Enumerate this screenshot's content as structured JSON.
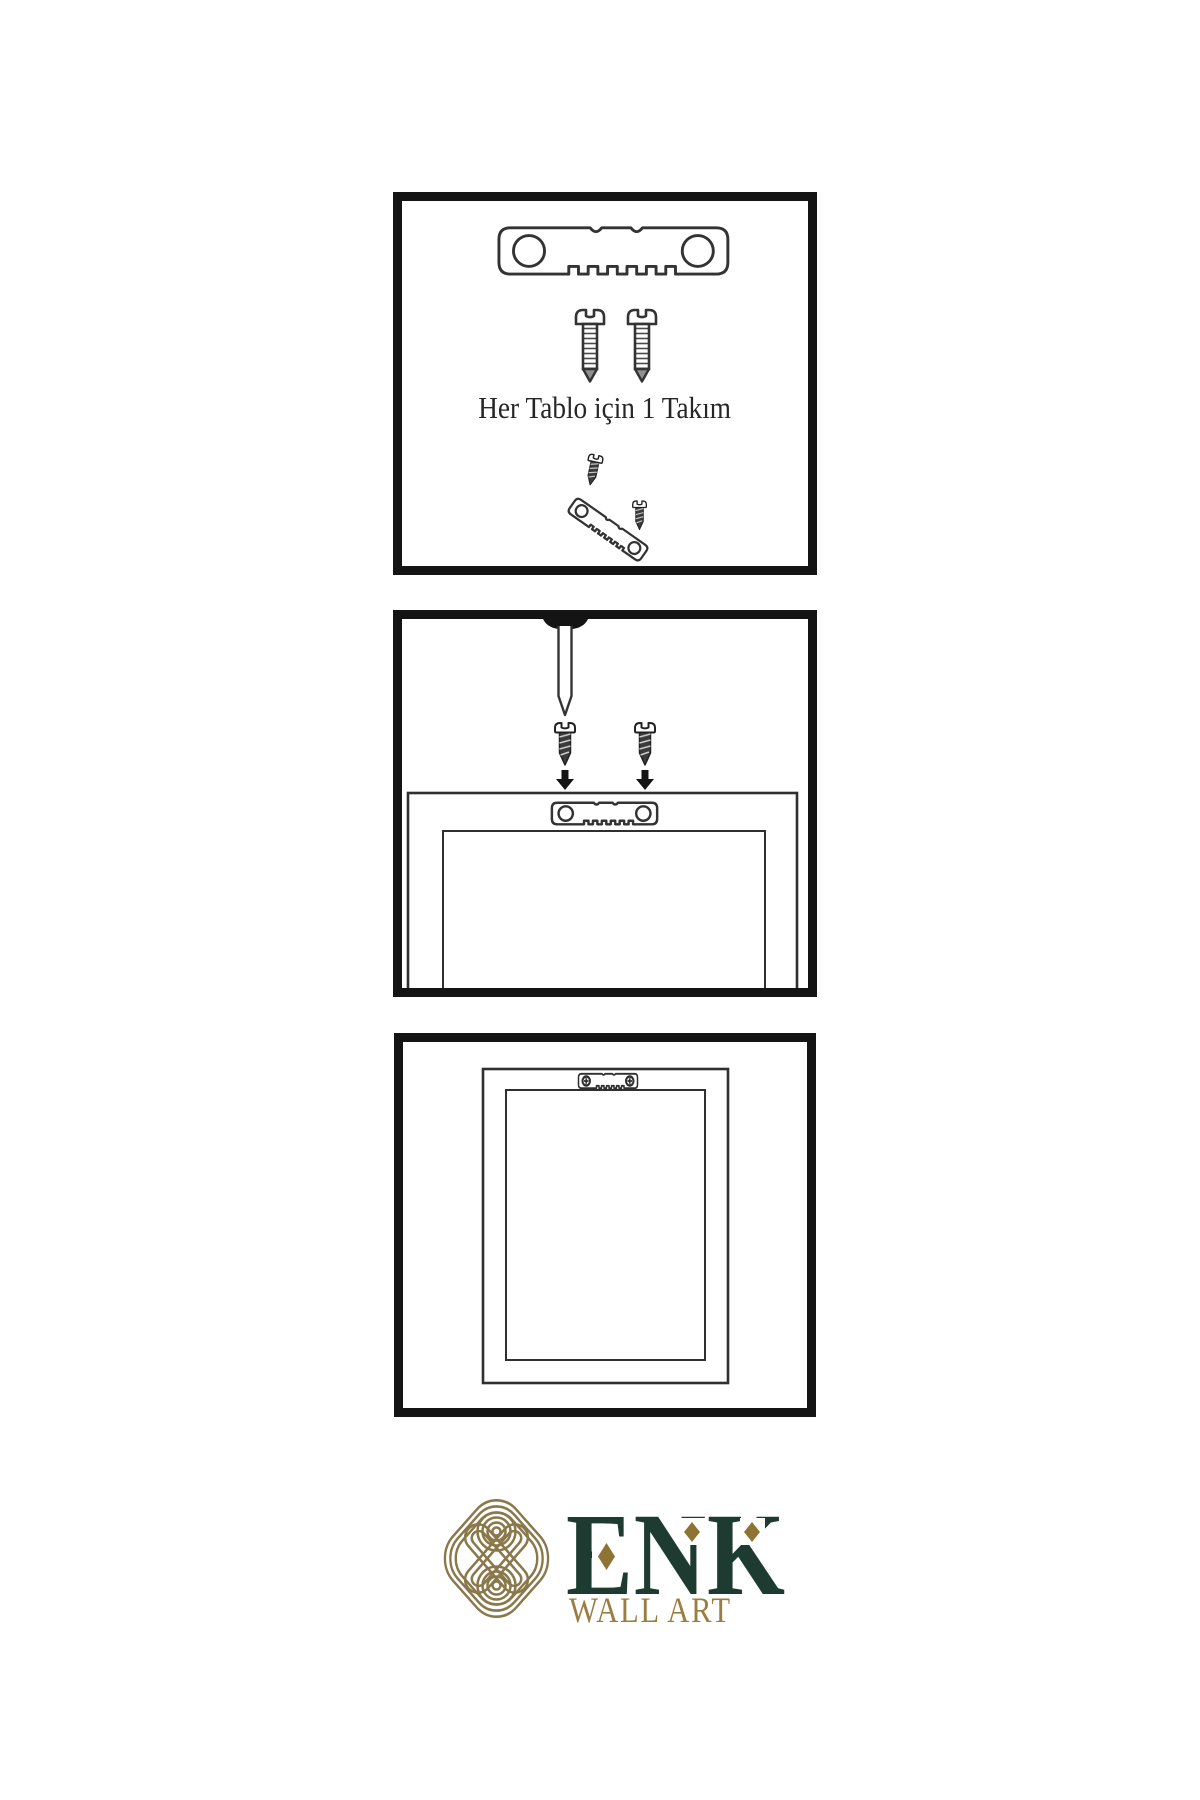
{
  "page": {
    "background_color": "#ffffff"
  },
  "colors": {
    "panel_border": "#141414",
    "line_art": "#333333",
    "dark_metal": "#3c3c3c",
    "logo_knot_gold": "#8a774a",
    "logo_brand_green": "#1d3b30",
    "logo_gold": "#9b7d42",
    "diamond_gold": "#8f7335"
  },
  "steps": [
    {
      "name": "hardware-kit",
      "caption": "Her Tablo için 1 Takım",
      "icons": [
        "sawtooth-hanger-icon",
        "screw-icon",
        "screw-icon",
        "angled-screw-icon",
        "angled-sawtooth-hanger-icon",
        "small-screw-icon"
      ]
    },
    {
      "name": "mounting",
      "icons": [
        "wall-nail-icon",
        "dark-screw-icon",
        "dark-screw-icon",
        "down-arrow-icon",
        "down-arrow-icon",
        "sawtooth-hanger-on-frame-icon",
        "frame-back-icon"
      ]
    },
    {
      "name": "hanging",
      "icons": [
        "frame-back-icon",
        "mounted-sawtooth-hanger-icon"
      ]
    }
  ],
  "logo": {
    "brand": "ENK",
    "tagline": "WALL ART"
  }
}
